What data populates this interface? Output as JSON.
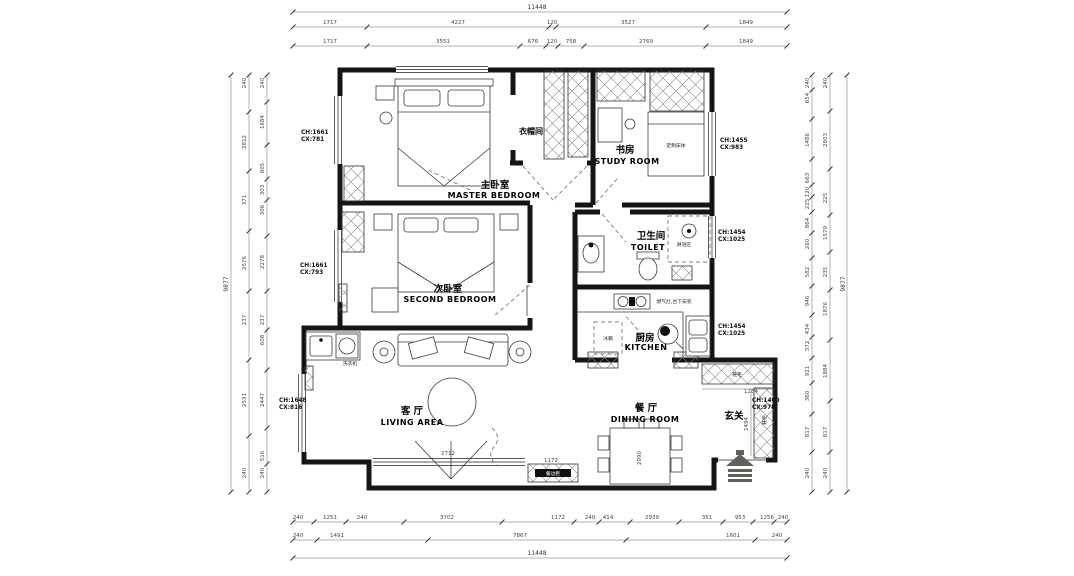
{
  "rooms": {
    "master": {
      "zh": "主卧室",
      "en": "MASTER BEDROOM"
    },
    "cloak": {
      "zh": "衣帽间"
    },
    "study": {
      "zh": "书房",
      "en": "STUDY ROOM"
    },
    "second": {
      "zh": "次卧室",
      "en": "SECOND BEDROOM"
    },
    "toilet": {
      "zh": "卫生间",
      "en": "TOILET"
    },
    "kitchen": {
      "zh": "厨房",
      "en": "KITCHEN"
    },
    "living": {
      "zh": "客 厅",
      "en": "LIVING AREA"
    },
    "dining": {
      "zh": "餐 厅",
      "en": "DINING ROOM"
    },
    "entry": {
      "zh": "玄关"
    }
  },
  "heights": {
    "left_top": [
      "CH:1661",
      "CX:781"
    ],
    "left_mid": [
      "CH:1661",
      "CX:793"
    ],
    "left_bottom": [
      "CH:1648",
      "CX:816"
    ],
    "right_top": [
      "CH:1455",
      "CX:983"
    ],
    "right_toilet": [
      "CH:1454",
      "CX:1025"
    ],
    "right_kitchen": [
      "CH:1454",
      "CX:1025"
    ],
    "right_entry": [
      "CH:1460",
      "CX:978"
    ]
  },
  "labels": {
    "fridge": "冰箱",
    "shoe_top": "鞋柜",
    "shoe_side": "鞋柜",
    "washer": "洗衣机",
    "stove": "燃气灶,台下安装",
    "study_bed": "定制床体",
    "sideboard": "餐边柜",
    "shower": "淋浴区"
  },
  "dims": {
    "top1": [
      "11448"
    ],
    "top2": [
      "1717",
      "4227",
      "120",
      "3527",
      "1849"
    ],
    "top3": [
      "1717",
      "3551",
      "676",
      "120",
      "758",
      "2769",
      "1849"
    ],
    "bot1": [
      "240",
      "1251",
      "240",
      "3702",
      "1172",
      "240",
      "414",
      "2939",
      "351",
      "953",
      "1256",
      "240"
    ],
    "bot2": [
      "240",
      "1491",
      "7867",
      "1601",
      "240"
    ],
    "bot3": [
      "11448"
    ],
    "left1": [
      "9877"
    ],
    "left2": [
      "240",
      "2812",
      "371",
      "2576",
      "237",
      "2531",
      "240"
    ],
    "left3": [
      "240",
      "1684",
      "805",
      "303",
      "306",
      "2278",
      "237",
      "608",
      "2447",
      "516",
      "240"
    ],
    "right1": [
      "9877"
    ],
    "right2": [
      "240",
      "2803",
      "225",
      "1579",
      "235",
      "1876",
      "1884",
      "817",
      "240"
    ],
    "right3": [
      "240",
      "654",
      "1486",
      "663",
      "120",
      "225",
      "864",
      "260",
      "582",
      "946",
      "434",
      "372",
      "921",
      "360",
      "817",
      "240"
    ],
    "inner": [
      "1264",
      "1494",
      "2990",
      "2712",
      "1172"
    ]
  }
}
